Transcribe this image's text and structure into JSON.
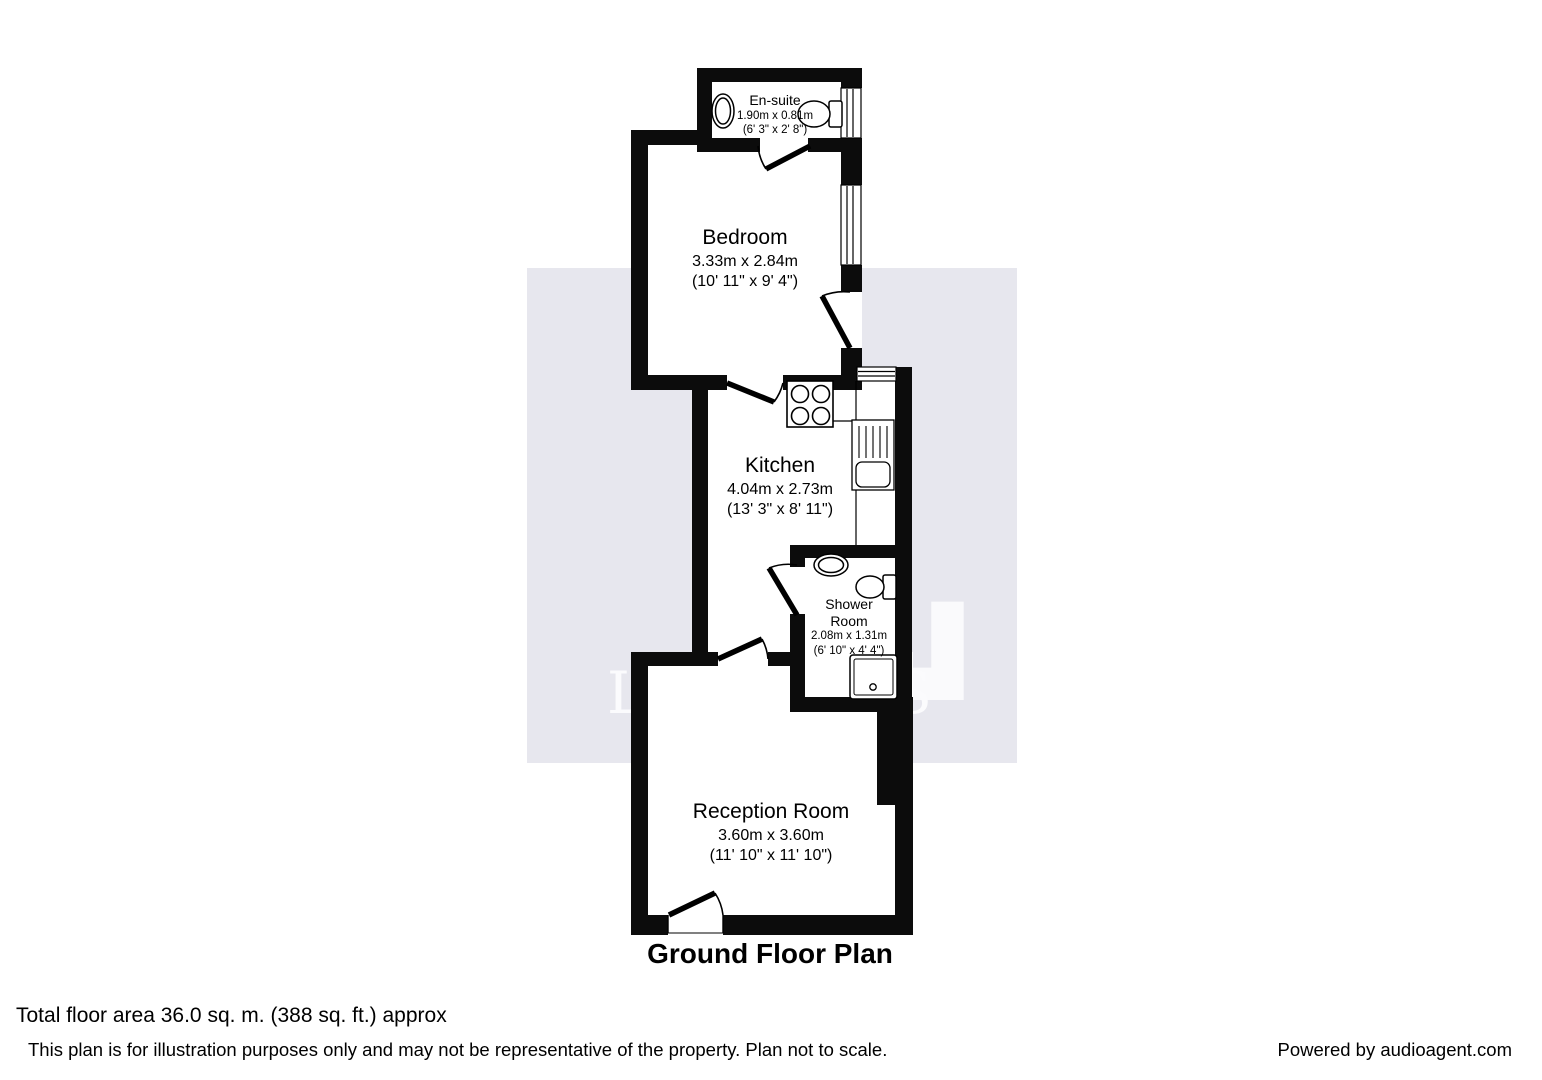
{
  "floorplan": {
    "title": "Ground Floor Plan",
    "watermark": {
      "letter": "L",
      "name": "LEADERS"
    },
    "rooms": [
      {
        "id": "ensuite",
        "name": "En-suite",
        "dims_m": "1.90m x 0.81m",
        "dims_ft": "(6' 3\" x 2' 8\")",
        "fixtures": [
          "sink",
          "toilet",
          "window"
        ]
      },
      {
        "id": "bedroom",
        "name": "Bedroom",
        "dims_m": "3.33m x 2.84m",
        "dims_ft": "(10' 11\" x 9' 4\")",
        "fixtures": [
          "window",
          "entry-door"
        ]
      },
      {
        "id": "kitchen",
        "name": "Kitchen",
        "dims_m": "4.04m x 2.73m",
        "dims_ft": "(13' 3\" x 8' 11\")",
        "fixtures": [
          "hob",
          "sink-drainer",
          "window"
        ]
      },
      {
        "id": "shower_room",
        "name": "Shower Room",
        "name_line1": "Shower",
        "name_line2": "Room",
        "dims_m": "2.08m x 1.31m",
        "dims_ft": "(6' 10\" x 4' 4\")",
        "fixtures": [
          "sink",
          "toilet",
          "shower-tray"
        ]
      },
      {
        "id": "reception",
        "name": "Reception Room",
        "dims_m": "3.60m x 3.60m",
        "dims_ft": "(11' 10\" x 11' 10\")",
        "fixtures": [
          "front-door"
        ]
      }
    ],
    "footer": {
      "total_area": "Total floor area 36.0 sq. m. (388 sq. ft.) approx",
      "disclaimer": "This plan is for illustration purposes only and may not be representative of the property. Plan not to scale.",
      "powered_by": "Powered by audioagent.com"
    },
    "colors": {
      "wall": "#0c0c0c",
      "room_fill": "#ffffff",
      "watermark_bg": "#e7e7ee",
      "watermark_glyph": "#fafafc",
      "text": "#000000"
    }
  }
}
